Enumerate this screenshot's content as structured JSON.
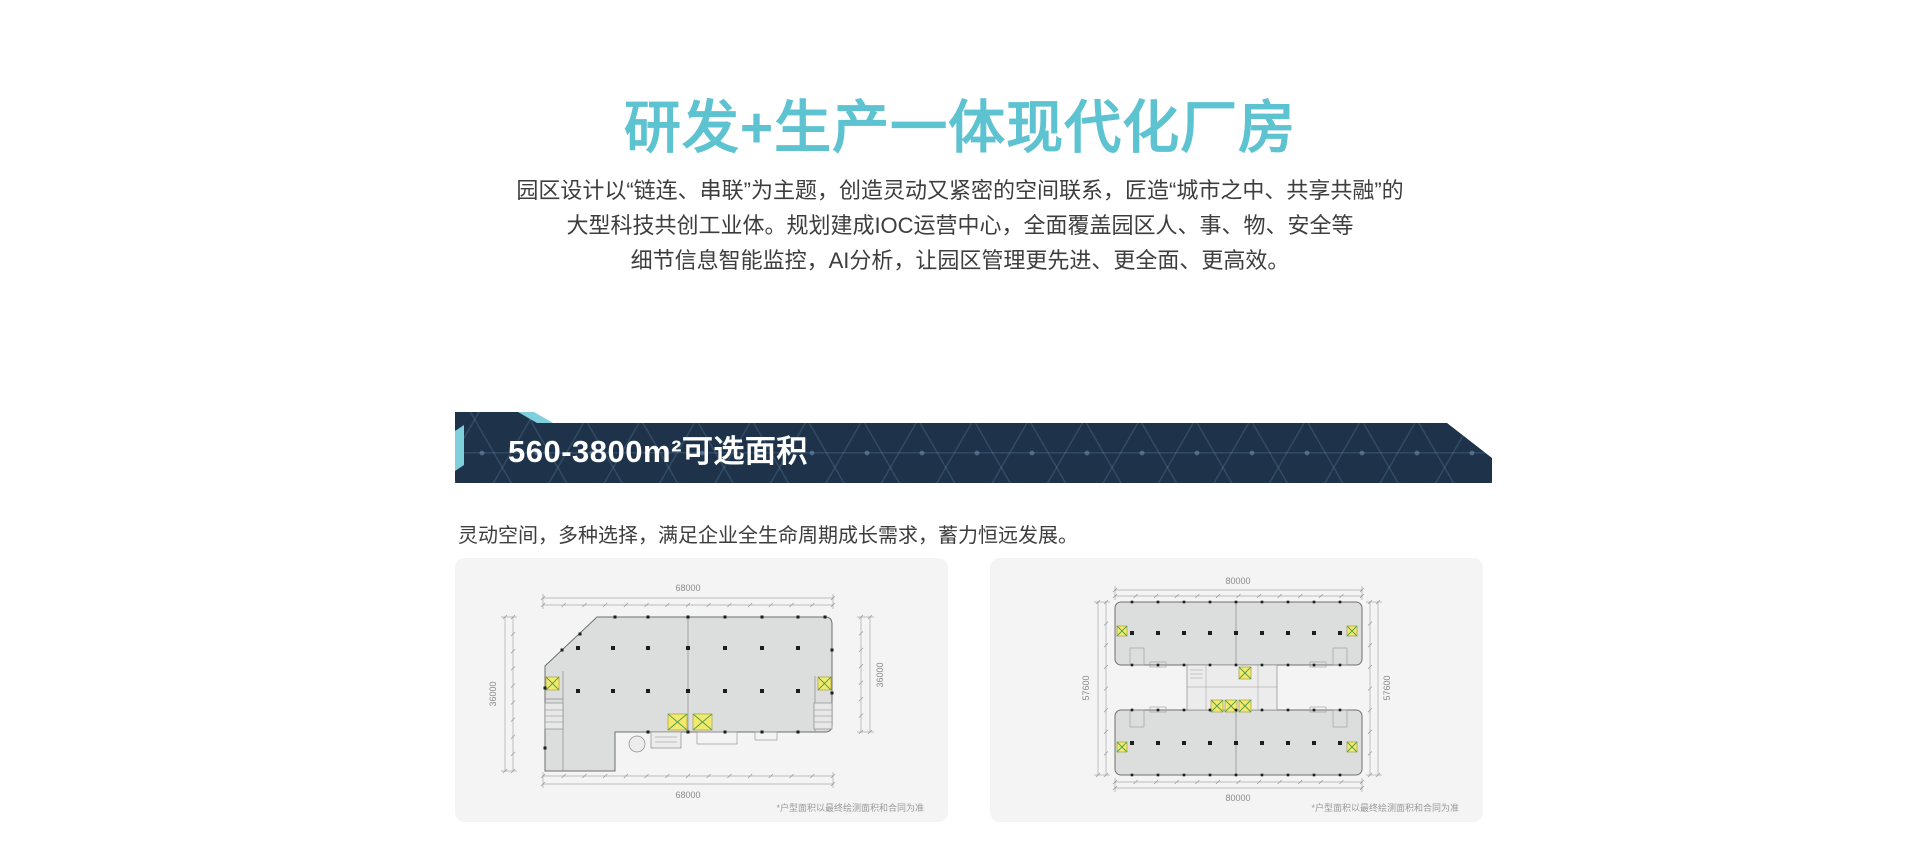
{
  "header": {
    "title": "研发+生产一体现代化厂房"
  },
  "intro": {
    "line1": "园区设计以“链连、串联”为主题，创造灵动又紧密的空间联系，匠造“城市之中、共享共融”的",
    "line2": "大型科技共创工业体。规划建成IOC运营中心，全面覆盖园区人、事、物、安全等",
    "line3": "细节信息智能监控，AI分析，让园区管理更先进、更全面、更高效。"
  },
  "banner": {
    "title": "560-3800m²可选面积"
  },
  "section": {
    "subtitle": "灵动空间，多种选择，满足企业全生命周期成长需求，蓄力恒远发展。"
  },
  "colors": {
    "accent_teal": "#5ec3d0",
    "banner_navy": "#1e3349",
    "banner_teal": "#7fd0dc",
    "card_bg": "#f4f4f4",
    "body_text": "#3d3d3d",
    "plan_fill": "#dcdddd",
    "elevator_yellow": "#f3ea6d",
    "elevator_green": "#4f9e4f"
  },
  "floorplans": {
    "left": {
      "dim_top": "68000",
      "dim_bottom": "68000",
      "dim_left": "36000",
      "dim_right": "36000",
      "footnote": "*户型面积以最终绘测面积和合同为准"
    },
    "right": {
      "dim_top": "80000",
      "dim_bottom": "80000",
      "dim_left": "57600",
      "dim_right": "57600",
      "footnote": "*户型面积以最终绘测面积和合同为准"
    }
  }
}
